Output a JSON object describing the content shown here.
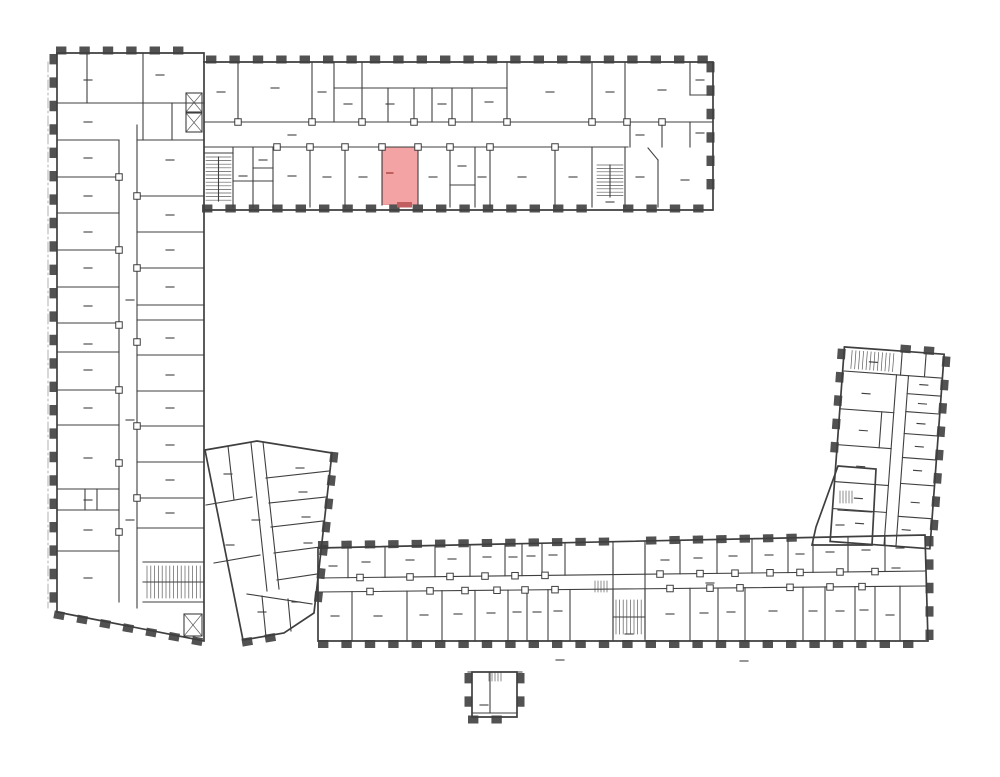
{
  "plan": {
    "background": "#ffffff",
    "wall_color": "#3f3f3f",
    "wall_color_light": "#8a8a8a"
  },
  "highlight": {
    "fill": "#f3a3a3",
    "stroke": "#e79a9a",
    "accent": "#c05f5f"
  }
}
